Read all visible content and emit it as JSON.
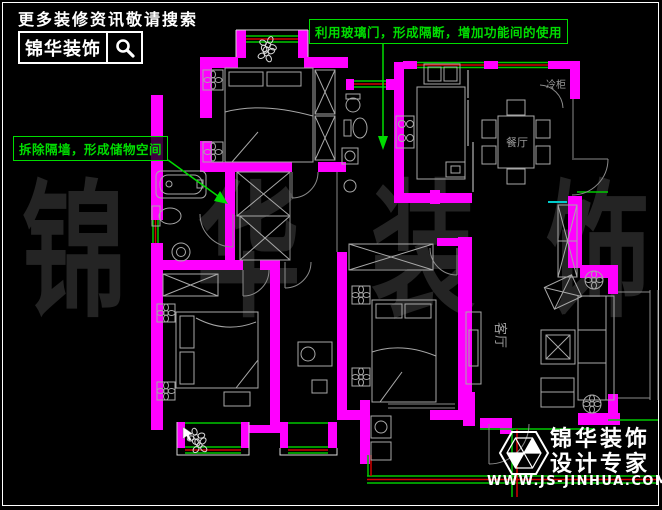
{
  "search_banner": {
    "tagline": "更多装修资讯敬请搜索",
    "brand": "锦华装饰"
  },
  "annotations": {
    "glass_door": "利用玻璃门，形成隔断，增加功能间的使用",
    "storage": "拆除隔墙，形成储物空间"
  },
  "watermark": {
    "char1": "锦",
    "char2": "华",
    "char3": "装",
    "char4": "饰"
  },
  "floorplan": {
    "room_labels": {
      "dining": "餐厅",
      "living": "客厅",
      "fridge": "冷柜"
    }
  },
  "footer": {
    "brand": "锦华装饰",
    "slogan": "设计专家",
    "website": "WWW.JS-JINHUA.COM"
  },
  "colors": {
    "wall": "#ff00ff",
    "window_green": "#00c800",
    "window_red": "#d40000",
    "annotation_green": "#00dd00",
    "furniture_gray": "#a8a8a8",
    "watermark_gray": "#242424",
    "cyan": "#00cccc"
  }
}
